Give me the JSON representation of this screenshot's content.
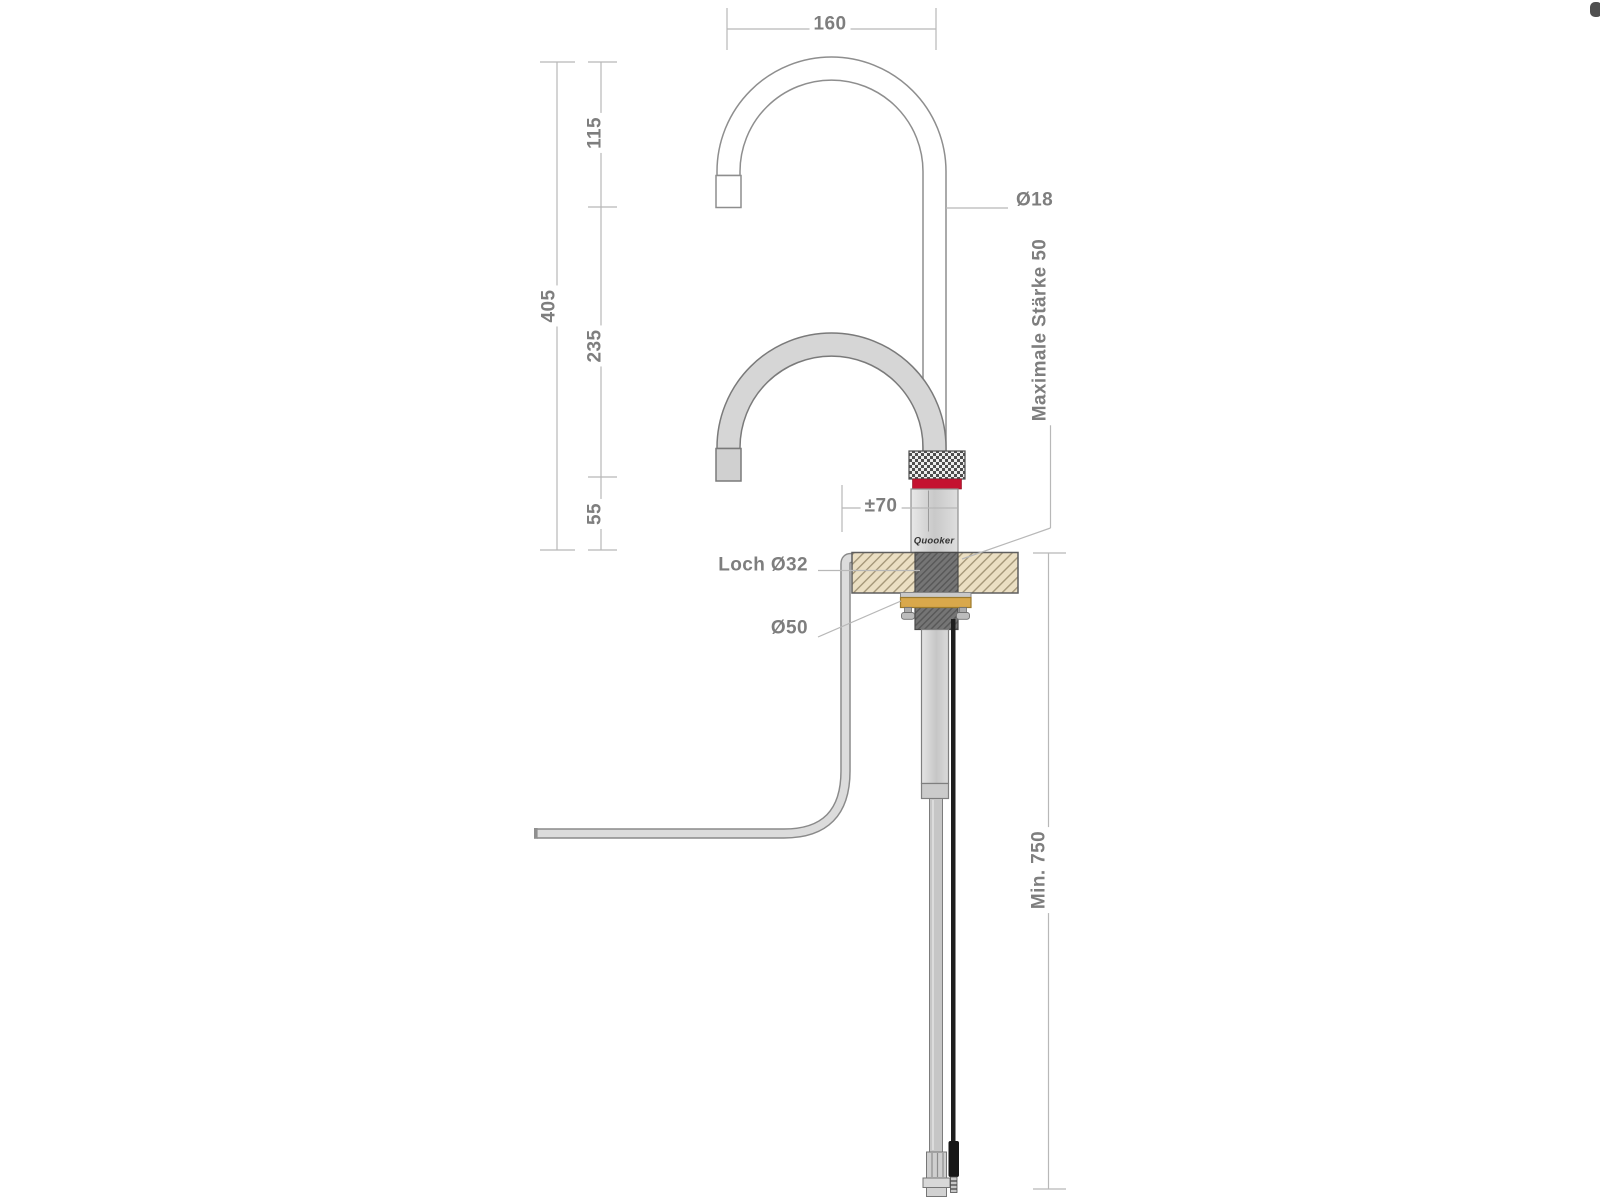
{
  "drawing": {
    "brand": "Quooker",
    "dimensions": {
      "spout_reach": "160",
      "total_height": "405",
      "upper_segment": "115",
      "middle_segment": "235",
      "lower_segment": "55",
      "spout_tube_diameter": "Ø18",
      "max_counter_thickness": "Maximale Stärke 50",
      "swivel_offset": "±70",
      "hole_diameter": "Loch Ø32",
      "flange_diameter": "Ø50",
      "min_clearance_below": "Min. 750"
    },
    "colors": {
      "indicator_red": "#c41230",
      "brass_flange": "#d9a84b",
      "counter_beige": "#ebdfc3"
    }
  }
}
